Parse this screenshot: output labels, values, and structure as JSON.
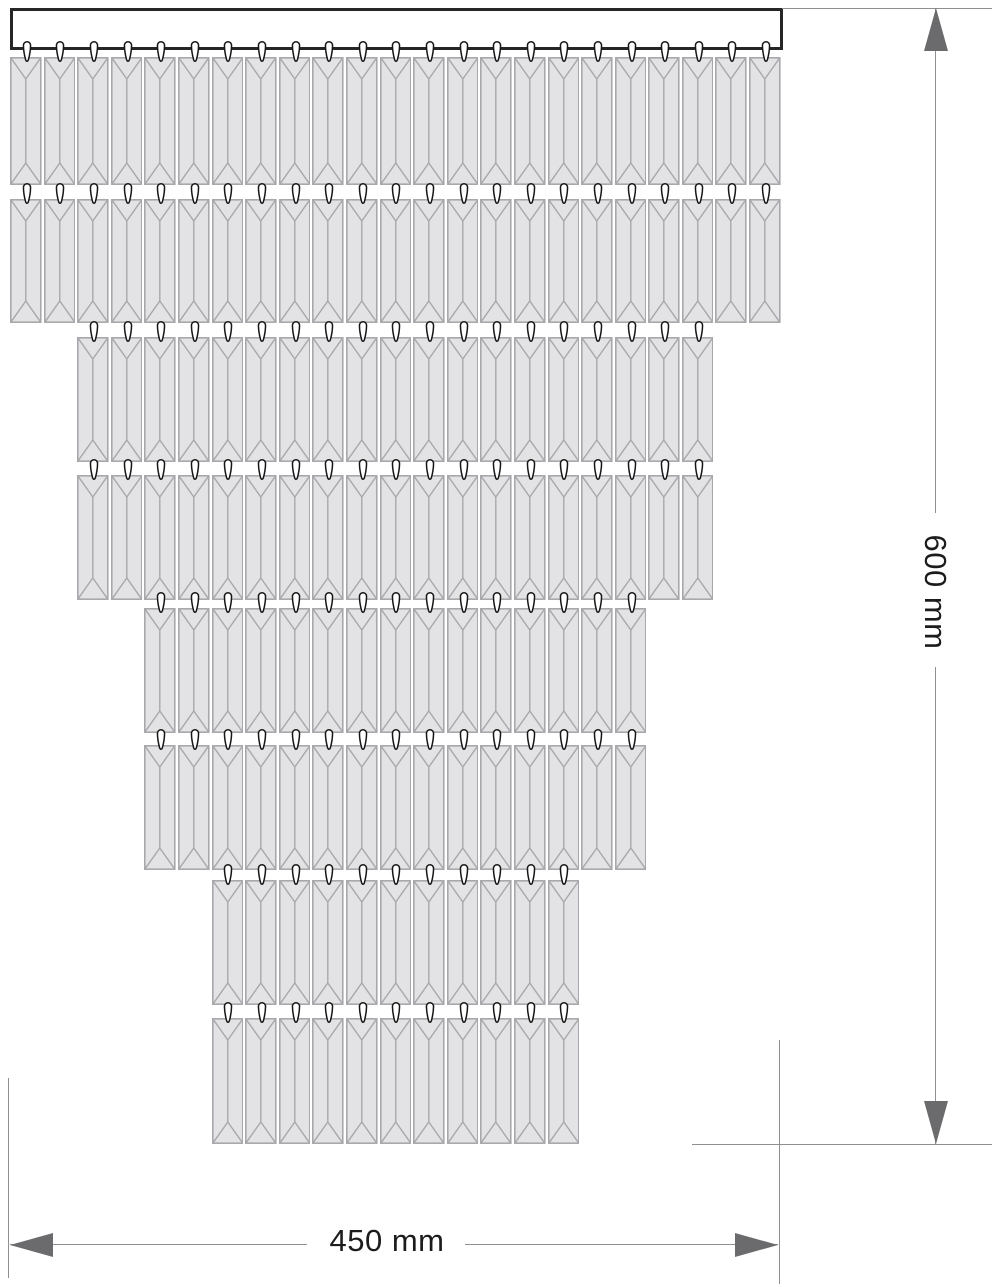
{
  "title": "Cascading crystal fixture technical drawing",
  "labels": {
    "height": "600 mm",
    "width": "450 mm"
  },
  "colors": {
    "background": "#ffffff",
    "crystal_fill": "#e3e3e5",
    "crystal_line": "#a8a8ac",
    "hook_fill": "#ffffff",
    "hook_outline": "#161616",
    "bar_fill": "#ffffff",
    "bar_border": "#262626",
    "dim_line": "#8f8f93",
    "dim_arrow": "#6b6b6e",
    "dim_text": "#1c1c1c"
  },
  "drawing": {
    "canvas": {
      "width": 992,
      "height": 1287
    },
    "bar": {
      "x": 10,
      "y": 8,
      "width": 772.8,
      "height": 42
    },
    "crystal_pitch": 33.6,
    "crystal_gap": 2,
    "crystal_bevel": 22,
    "hook": {
      "width": 10,
      "height": 21,
      "rise": 16
    },
    "rows": [
      {
        "name": "row-1",
        "left": 10,
        "top": 57,
        "height": 128,
        "count": 23
      },
      {
        "name": "row-2",
        "left": 10,
        "top": 199,
        "height": 124,
        "count": 23
      },
      {
        "name": "row-3",
        "left": 77.2,
        "top": 337,
        "height": 125,
        "count": 19
      },
      {
        "name": "row-4",
        "left": 77.2,
        "top": 475,
        "height": 125,
        "count": 19
      },
      {
        "name": "row-5",
        "left": 144.4,
        "top": 608,
        "height": 125,
        "count": 15
      },
      {
        "name": "row-6",
        "left": 144.4,
        "top": 745,
        "height": 125,
        "count": 15
      },
      {
        "name": "row-7",
        "left": 211.6,
        "top": 880,
        "height": 125,
        "count": 11
      },
      {
        "name": "row-8",
        "left": 211.6,
        "top": 1018,
        "height": 126,
        "count": 11
      }
    ],
    "dimensions": {
      "height_dim": {
        "line_x": 935,
        "y1": 8,
        "y2": 1144,
        "text_gap_start": 513,
        "text_gap_end": 667,
        "ext_top": {
          "y": 8,
          "x1": 782,
          "x2": 992
        },
        "ext_bottom": {
          "y": 1144,
          "x1": 692,
          "x2": 992
        },
        "arrow_width": 24,
        "arrow_length": 43,
        "label_x": 935,
        "label_y": 592
      },
      "width_dim": {
        "line_y": 1244,
        "x1": 10,
        "x2": 778,
        "text_gap_start": 307,
        "text_gap_end": 465,
        "ext_left": {
          "x": 8,
          "y1": 1078,
          "y2": 1278
        },
        "ext_right": {
          "x": 779,
          "y1": 1040,
          "y2": 1284
        },
        "arrow_width": 24,
        "arrow_length": 43,
        "label_x": 387,
        "label_y": 1241
      }
    }
  }
}
